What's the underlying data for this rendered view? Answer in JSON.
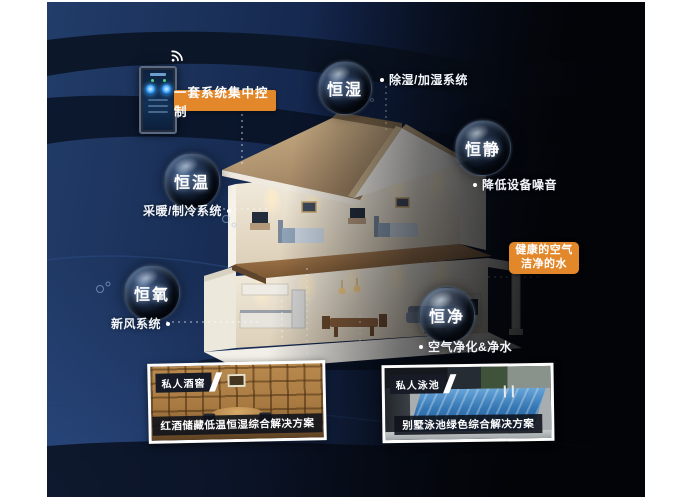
{
  "theme": {
    "panel_navy": "#1a3058",
    "panel_black": "#04060c",
    "accent_orange": "#e2872a",
    "text_white": "#ffffff"
  },
  "control_banner": {
    "label": "一套系统集中控制"
  },
  "bubbles": {
    "humidity": {
      "title": "恒湿",
      "note": "除湿/加湿系统"
    },
    "quiet": {
      "title": "恒静",
      "note": "降低设备噪音"
    },
    "temperature": {
      "title": "恒温",
      "note": "采暖/制冷系统"
    },
    "oxygen": {
      "title": "恒氧",
      "note": "新风系统"
    },
    "purity": {
      "title": "恒净",
      "note": "空气净化&净水"
    }
  },
  "callout": {
    "line1": "健康的空气",
    "line2": "洁净的水"
  },
  "photos": {
    "wine": {
      "tag": "私人酒窖",
      "caption": "红酒储藏低温恒湿综合解决方案"
    },
    "pool": {
      "tag": "私人泳池",
      "caption": "别墅泳池绿色综合解决方案"
    }
  }
}
